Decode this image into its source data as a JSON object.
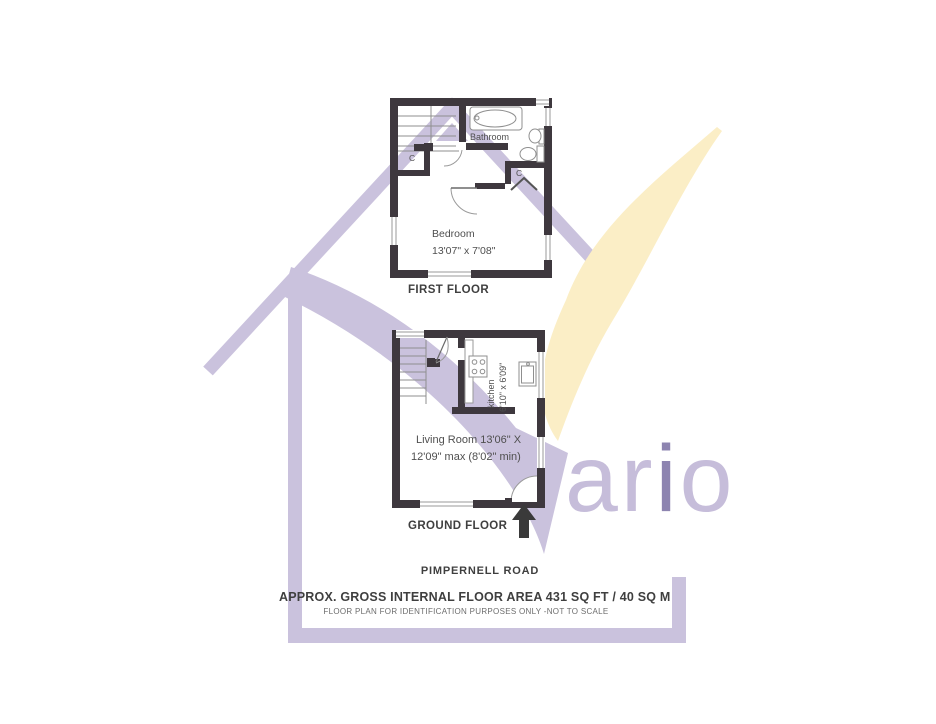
{
  "watermark": {
    "letters": {
      "l1": "a",
      "l2": "r",
      "l3": "i",
      "l4": "o"
    },
    "colors": {
      "lavender": "#cac2dd",
      "accent_purple": "#8d84b0",
      "gold": "#fbeec6"
    }
  },
  "plan_style": {
    "wall_color": "#3e383e",
    "line_color": "#8f8f8f"
  },
  "first_floor": {
    "title": "FIRST FLOOR",
    "bathroom_label": "Bathroom",
    "bedroom_label": "Bedroom",
    "bedroom_dimensions": "13'07\" x 7'08\"",
    "closet_left_label": "C",
    "closet_right_label": "C"
  },
  "ground_floor": {
    "title": "GROUND FLOOR",
    "kitchen_label": "kitchen",
    "kitchen_dimensions": "6'10\" x 6'09\"",
    "living_room_line1": "Living Room 13'06\" X",
    "living_room_line2": "12'09\" max (8'02\" min)"
  },
  "footer": {
    "road_name": "PIMPERNELL ROAD",
    "area_text": "APPROX. GROSS INTERNAL FLOOR AREA 431 SQ FT / 40 SQ M",
    "disclaimer": "FLOOR PLAN FOR IDENTIFICATION PURPOSES ONLY -NOT TO SCALE"
  }
}
